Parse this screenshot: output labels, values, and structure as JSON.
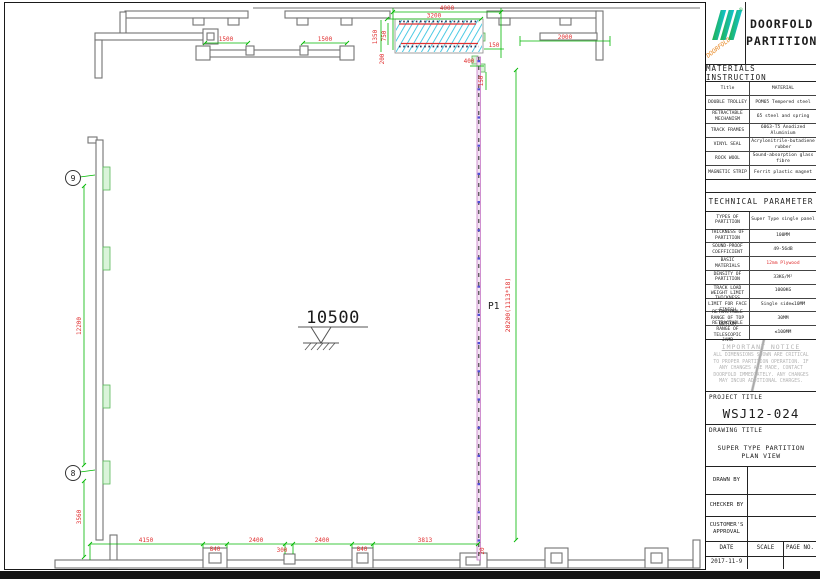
{
  "title_block": {
    "brand": {
      "line1": "DOORFOLD",
      "line2": "PARTITION",
      "logo_text": "DOORFOLD",
      "registered": "®"
    },
    "materials": {
      "header": "MATERIALS INSTRUCTION",
      "col_title": "Title",
      "col_material": "MATERIAL",
      "rows": [
        {
          "title": "DOUBLE TROLLEY",
          "material": "POM65 Tempered steel"
        },
        {
          "title": "RETRACTABLE MECHANISM",
          "material": "65 steel and spring"
        },
        {
          "title": "TRACK FRAMES",
          "material": "6063-T5 Anodized Aluminium"
        },
        {
          "title": "VINYL SEAL",
          "material": "Acrylonitrile-butadiene rubber"
        },
        {
          "title": "ROCK WOOL",
          "material": "Sound-absorption glass fibre"
        },
        {
          "title": "MAGNETIC STRIP",
          "material": "Ferrit plastic magnet"
        }
      ]
    },
    "technical": {
      "header": "TECHNICAL PARAMETER",
      "rows": [
        {
          "title": "TYPES OF PARTITION",
          "value": "Super Type single panel"
        },
        {
          "title": "THICKNESS OF PARTITION",
          "value": "100MM"
        },
        {
          "title": "SOUND-PROOF COEFFICIENT",
          "value": "49-56dB"
        },
        {
          "title": "BASIC MATERIALS",
          "value": "12mm Plywood"
        },
        {
          "title": "DENSITY OF PARTITION",
          "value": "33KG/M²"
        },
        {
          "title": "TRACK LOAD WEIGHT LIMIT",
          "value": "1000KG"
        },
        {
          "title": "THICKNESS LIMIT FOR FACE FINISH",
          "value": "Single side≤10MM"
        },
        {
          "title": "RETRACTABLE RANGE OF TOP BOTTOM",
          "value": "30MM"
        },
        {
          "title": "RETRACTABLE RANGE OF TELESCOPIC JAMB",
          "value": "≤100MM"
        }
      ]
    },
    "notice": {
      "header": "IMPORTANT NOTICE",
      "body": "ALL DIMENSIONS SHOWN ARE CRITICAL TO PROPER PARTITION OPERATION. IF ANY CHANGES ARE MADE, CONTACT DOORFOLD IMMEDIATELY. ANY CHANGES MAY INCUR ADDITIONAL CHARGES."
    },
    "project": {
      "label": "PROJECT TITLE",
      "value": "WSJ12-024"
    },
    "drawing_title": {
      "label": "DRAWING TITLE",
      "value": "SUPER TYPE PARTITION PLAN VIEW"
    },
    "signoff": {
      "drawn_by": "DRAWN BY",
      "checker_by": "CHECKER BY",
      "customer": "CUSTOMER'S APPROVAL"
    },
    "footer": {
      "date_label": "DATE",
      "scale_label": "SCALE",
      "page_label": "PAGE NO.",
      "date_value": "2017-11-9"
    }
  },
  "drawing": {
    "level_mark": "10500",
    "panel_label": "P1",
    "grid_bubbles": {
      "top": "9",
      "bottom": "8"
    },
    "dims": {
      "d4000": "4000",
      "d3200": "3200",
      "d1500a": "1500",
      "d1500b": "1500",
      "d2000": "2000",
      "d1350": "1350",
      "d750": "750",
      "d200": "200",
      "d150a": "150",
      "d400": "400",
      "d150b": "150",
      "d12200": "12200",
      "d3560": "3560",
      "d4150": "4150",
      "d840a": "840",
      "d2400a": "2400",
      "d300": "300",
      "d2400b": "2400",
      "d840b": "840",
      "d3813": "3813",
      "d20": "20",
      "track_length": "20200(1113*18)"
    },
    "colors": {
      "dimension_line": "#00b800",
      "dimension_text": "#e03030",
      "wall": "#737373",
      "panel_hatch": "#2fc1e0",
      "track": "#c87cc8",
      "track_dot": "#5050d8",
      "wall_feature": "#58b858",
      "logo_green": "#23b14d",
      "logo_cyan": "#0fc3d6",
      "logo_label": "#e8861e"
    }
  }
}
